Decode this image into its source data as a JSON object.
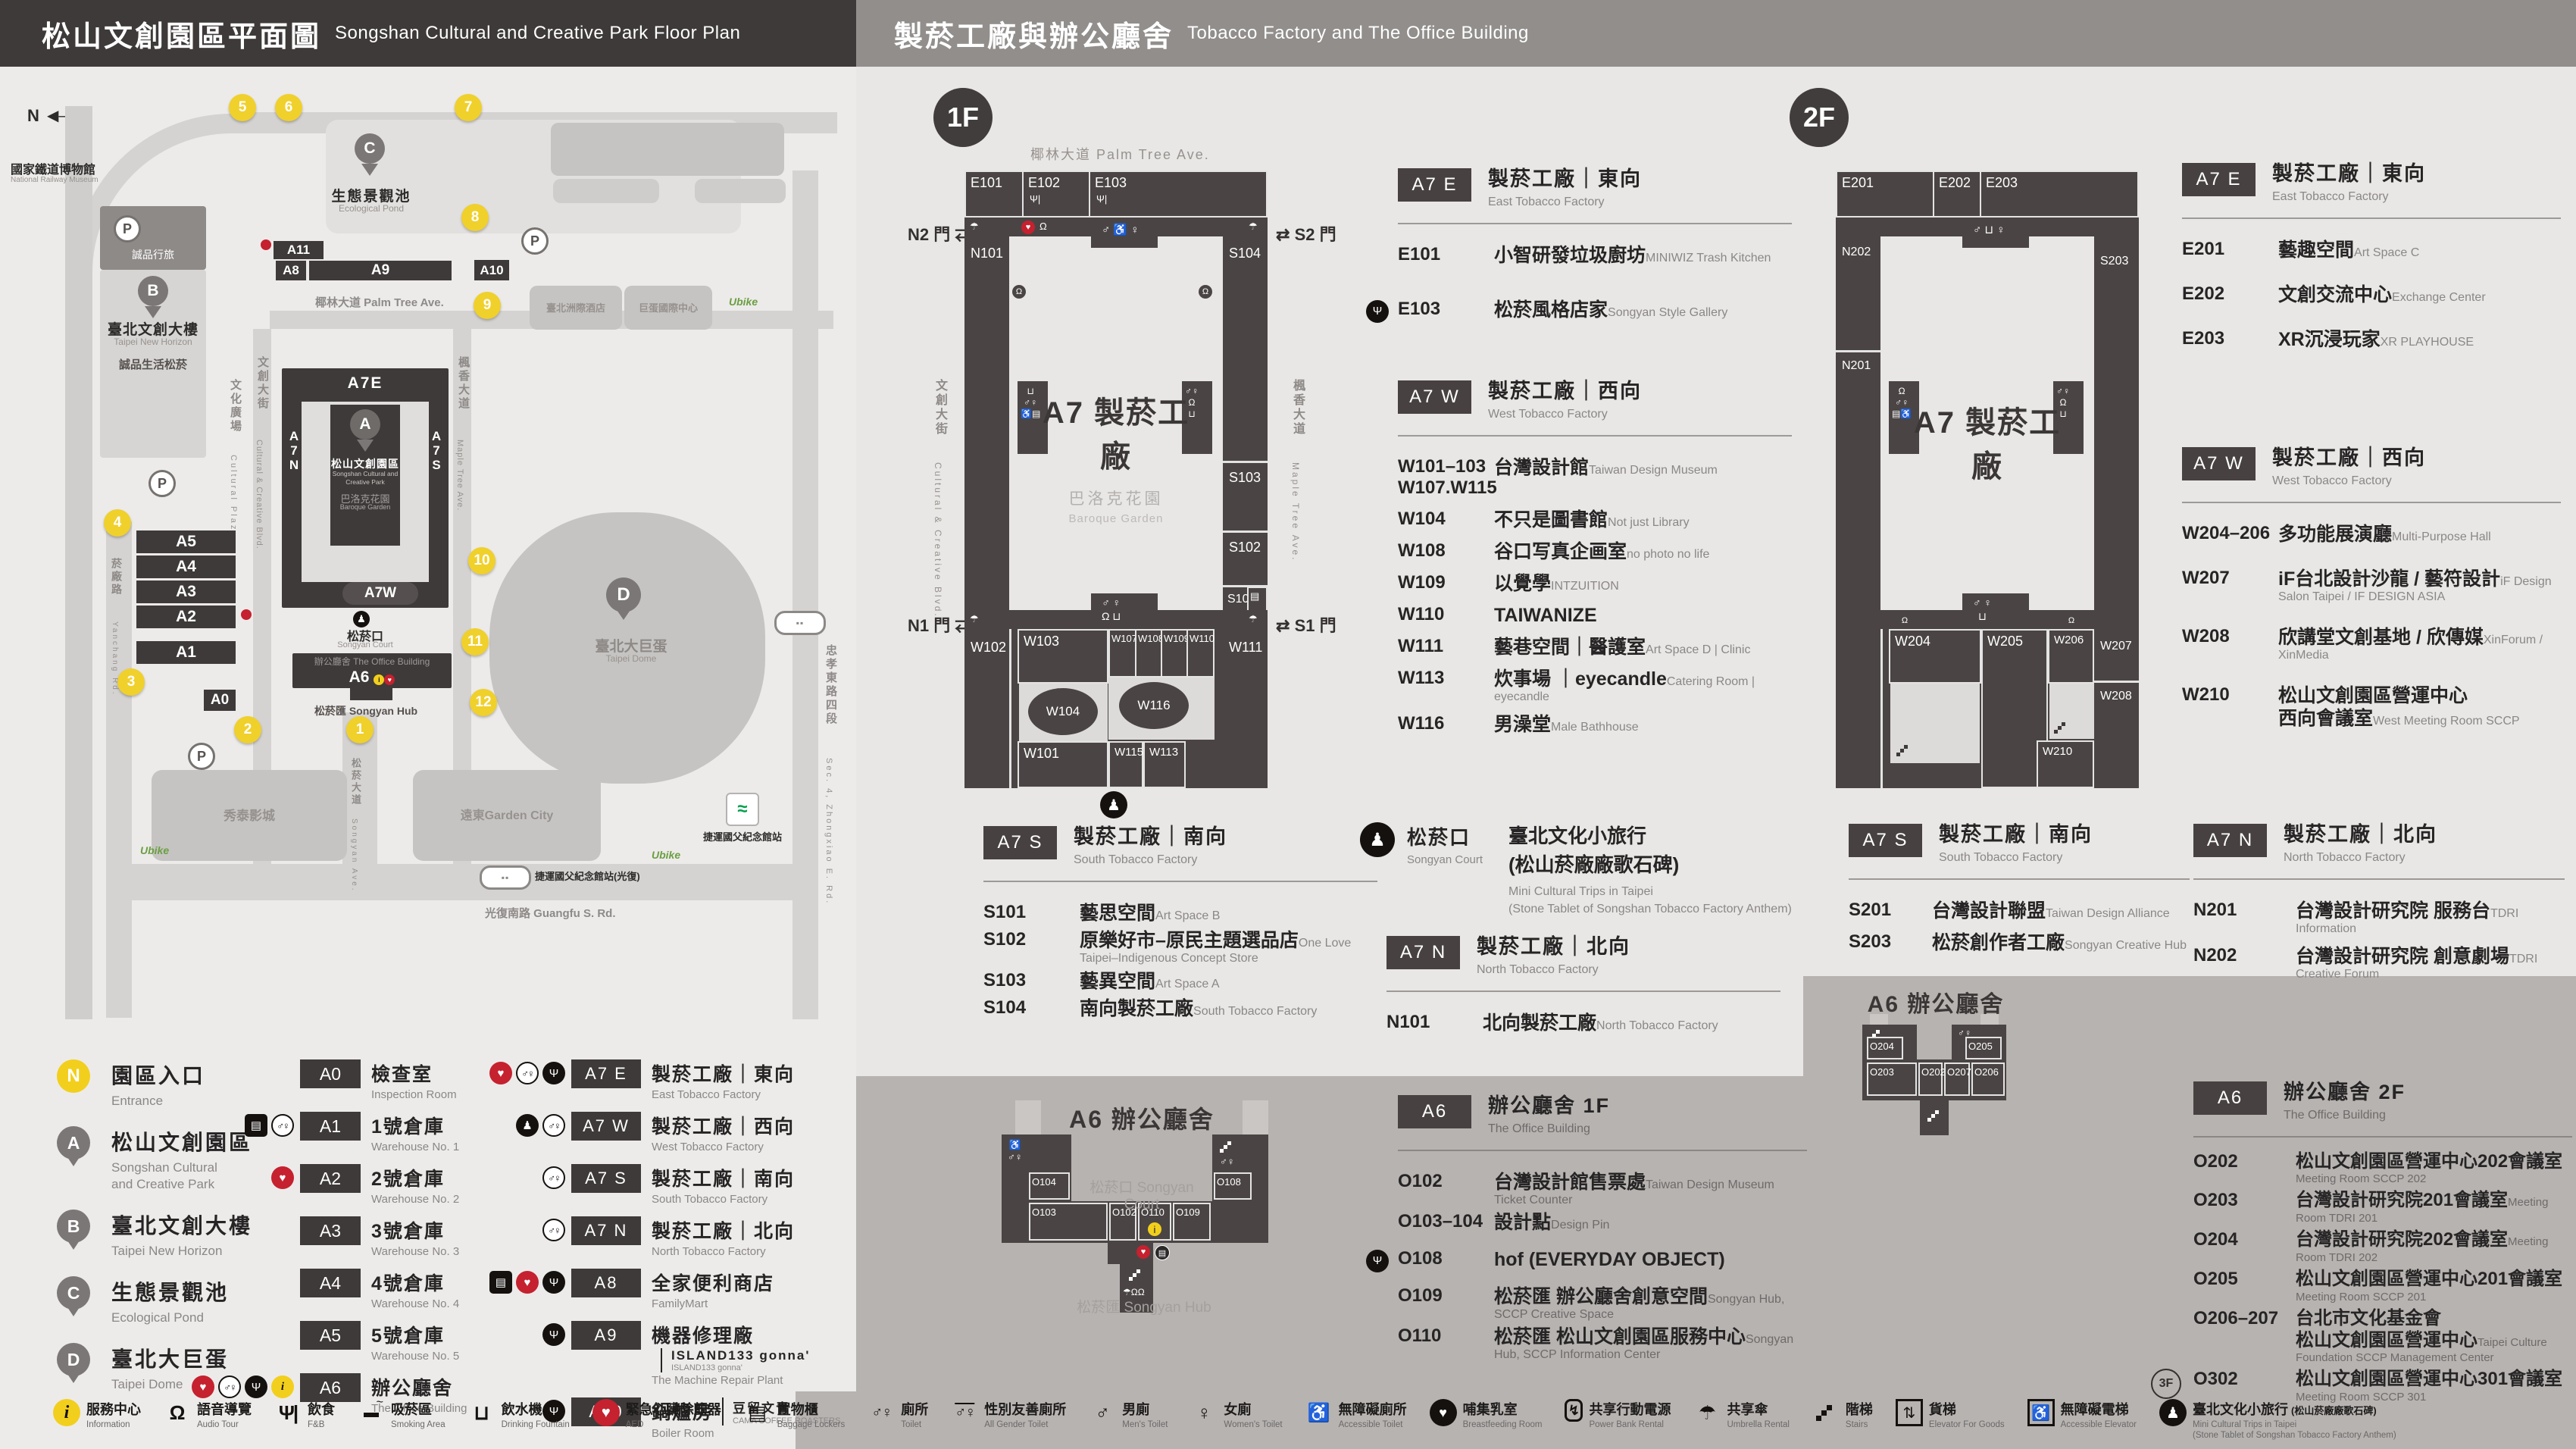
{
  "left": {
    "header": {
      "zh": "松山文創園區平面圖",
      "en": "Songshan Cultural and Creative Park Floor Plan"
    },
    "map": {
      "compass": "N",
      "gates": [
        "1",
        "2",
        "3",
        "4",
        "5",
        "6",
        "7",
        "8",
        "9",
        "10",
        "11",
        "12"
      ],
      "bars": {
        "a11": "A11",
        "a8": "A8",
        "a9": "A9",
        "a10": "A10",
        "a5": "A5",
        "a4": "A4",
        "a3": "A3",
        "a2": "A2",
        "a1": "A1",
        "a0": "A0"
      },
      "a7": {
        "e": "A7E",
        "w": "A7W",
        "n": "A7N",
        "s": "A7S",
        "pin": "A",
        "name_zh": "松山文創園區",
        "name_en1": "Songshan Cultural and",
        "name_en2": "Creative Park",
        "garden_zh": "巴洛克花園",
        "garden_en": "Baroque Garden"
      },
      "a6": {
        "tag": "A6",
        "zh": "辦公廳舍",
        "en": "The Office Building",
        "court_zh": "松菸口",
        "court_en": "Songyan Court",
        "hub": "松菸匯 Songyan Hub"
      },
      "streets": {
        "lane553": "忠孝東路四段553巷 La. 553, Sec. 4, Zhongxiao E. Rd.",
        "palm": "椰林大道 Palm Tree Ave.",
        "cultural_zh": "文創大街",
        "cultural_en": "Cultural & Creative Blvd.",
        "maple_zh": "楓香大道",
        "maple_en": "Maple Tree Ave.",
        "songyan_zh": "松菸大道",
        "songyan_en": "Songyan Ave.",
        "yanchang_zh": "菸廠路",
        "yanchang_en": "Yanchang Rd.",
        "plaza_zh": "文化廣場",
        "plaza_en": "Cultural Plaza",
        "guangfu": "光復南路 Guangfu S. Rd.",
        "zhongxiao_zh": "忠孝東路四段",
        "zhongxiao_en": "Sec. 4, Zhongxiao E. Rd."
      },
      "places": {
        "museum_zh": "國家鐵道博物館",
        "museum_en": "National Railway Museum",
        "pond_pin": "C",
        "pond_zh": "生態景觀池",
        "pond_en": "Ecological Pond",
        "hotel": "誠品行旅",
        "b_pin": "B",
        "b_zh": "臺北文創大樓",
        "b_en": "Taipei New Horizon",
        "eslite": "誠品生活松菸",
        "d_pin": "D",
        "d_zh": "臺北大巨蛋",
        "d_en": "Taipei Dome",
        "intercont": "臺北洲際酒店",
        "domeintl": "巨蛋國際中心",
        "cinema": "秀泰影城",
        "garden_city": "遠東Garden City",
        "mrt": "捷運國父紀念館站",
        "mrt_exit": "捷運國父紀念館站(光復)",
        "ubike": "Ubike",
        "parking": "P"
      }
    },
    "pins": [
      {
        "id": "N",
        "gold": true,
        "zh": "園區入口",
        "en": "Entrance"
      },
      {
        "id": "A",
        "pin": true,
        "zh": "松山文創園區",
        "en": "Songshan Cultural\nand Creative Park"
      },
      {
        "id": "B",
        "pin": true,
        "zh": "臺北文創大樓",
        "en": "Taipei New Horizon"
      },
      {
        "id": "C",
        "pin": true,
        "zh": "生態景觀池",
        "en": "Ecological Pond"
      },
      {
        "id": "D",
        "pin": true,
        "zh": "臺北大巨蛋",
        "en": "Taipei Dome"
      }
    ],
    "legend_a": [
      {
        "code": "A0",
        "zh": "檢查室",
        "en": "Inspection Room",
        "icons": []
      },
      {
        "code": "A1",
        "zh": "1號倉庫",
        "en": "Warehouse No. 1",
        "icons": [
          "locker",
          "toilet"
        ]
      },
      {
        "code": "A2",
        "zh": "2號倉庫",
        "en": "Warehouse No. 2",
        "icons": [
          "aed"
        ]
      },
      {
        "code": "A3",
        "zh": "3號倉庫",
        "en": "Warehouse No. 3",
        "icons": []
      },
      {
        "code": "A4",
        "zh": "4號倉庫",
        "en": "Warehouse No. 4",
        "icons": []
      },
      {
        "code": "A5",
        "zh": "5號倉庫",
        "en": "Warehouse No. 5",
        "icons": []
      },
      {
        "code": "A6",
        "zh": "辦公廳舍",
        "en": "The Office Building",
        "icons": [
          "aed",
          "toilet",
          "fnb",
          "info"
        ]
      }
    ],
    "legend_b": [
      {
        "code": "A7 E",
        "zh": "製菸工廠｜東向",
        "en": "East Tobacco Factory",
        "icons": [
          "aed",
          "toilet",
          "fnb"
        ]
      },
      {
        "code": "A7 W",
        "zh": "製菸工廠｜西向",
        "en": "West Tobacco Factory",
        "icons": [
          "statue",
          "toilet"
        ]
      },
      {
        "code": "A7 S",
        "zh": "製菸工廠｜南向",
        "en": "South Tobacco Factory",
        "icons": [
          "toilet"
        ]
      },
      {
        "code": "A7 N",
        "zh": "製菸工廠｜北向",
        "en": "North Tobacco Factory",
        "icons": [
          "toilet"
        ]
      },
      {
        "code": "A8",
        "zh": "全家便利商店",
        "en": "FamilyMart",
        "icons": [
          "locker",
          "aed",
          "fnb"
        ]
      },
      {
        "code": "A9",
        "zh": "機器修理廠",
        "side": "ISLAND133 gonna'",
        "side2": "ISLAND133 gonna'",
        "en": "The Machine Repair Plant",
        "icons": [
          "fnb"
        ]
      },
      {
        "code": "A10",
        "zh": "鍋爐房",
        "side": "豆留文青",
        "side2": "CAMA COFFEE ROASTERS",
        "en": "Boiler Room",
        "icons": [
          "fnb"
        ]
      },
      {
        "code": "A11",
        "zh": "育嬰室",
        "side": "光一 一個時間",
        "side2": "GUANG YI IN TIME",
        "en": "The Nursery Room",
        "icons": [
          "fnb"
        ]
      }
    ]
  },
  "right": {
    "header": {
      "zh": "製菸工廠與辦公廳舍",
      "en": "Tobacco Factory and The Office Building"
    },
    "f1": {
      "badge": "1F",
      "plan": {
        "street_top": "椰林大道 Palm Tree Ave.",
        "street_left_zh": "文創大街",
        "street_left_en": "Cultural & Creative Blvd.",
        "street_right_zh": "楓香大道",
        "street_right_en": "Maple Tree Ave.",
        "gate_n2": "N2 門",
        "gate_s2": "S2 門",
        "gate_n1": "N1 門",
        "gate_s1": "S1 門",
        "arrows": "⇄",
        "center": "A7 製菸工廠",
        "garden_zh": "巴洛克花園",
        "garden_en": "Baroque Garden",
        "rooms": {
          "e101": "E101",
          "e102": "E102",
          "e103": "E103",
          "n101": "N101",
          "s104": "S104",
          "s103": "S103",
          "s102": "S102",
          "s101": "S101",
          "w102": "W102",
          "w103": "W103",
          "w104": "W104",
          "w107": "W107",
          "w108": "W108",
          "w109": "W109",
          "w110": "W110",
          "w111": "W111",
          "w115": "W115",
          "w113": "W113",
          "w116": "W116",
          "w101": "W101"
        }
      },
      "a7e": {
        "badge": "A7 E",
        "zh": "製菸工廠｜東向",
        "en": "East Tobacco Factory",
        "items": [
          {
            "code": "E101",
            "zh": "小智研發垃圾廚坊",
            "en": "MINIWIZ Trash Kitchen"
          },
          {
            "code": "E103",
            "zh": "松菸風格店家",
            "en": "Songyan Style Gallery",
            "fnb": true
          }
        ]
      },
      "a7w": {
        "badge": "A7 W",
        "zh": "製菸工廠｜西向",
        "en": "West Tobacco Factory",
        "items": [
          {
            "code": "W101–103\nW107.W115",
            "zh": "台灣設計館",
            "en": "Taiwan Design Museum"
          },
          {
            "code": "W104",
            "zh": "不只是圖書館",
            "en": "Not just Library"
          },
          {
            "code": "W108",
            "zh": "谷口写真企画室",
            "en": "no photo no life"
          },
          {
            "code": "W109",
            "zh": "以覺學",
            "en": "INTZUITION"
          },
          {
            "code": "W110",
            "zh": "TAIWANIZE"
          },
          {
            "code": "W111",
            "zh": "藝巷空間｜醫護室",
            "en": "Art Space D | Clinic"
          },
          {
            "code": "W113",
            "zh": "炊事場 ｜eyecandle",
            "en": "Catering Room | eyecandle"
          },
          {
            "code": "W116",
            "zh": "男澡堂",
            "en": "Male Bathhouse"
          }
        ]
      },
      "a7s": {
        "badge": "A7 S",
        "zh": "製菸工廠｜南向",
        "en": "South Tobacco Factory",
        "items": [
          {
            "code": "S101",
            "zh": "藝思空間",
            "en": "Art Space B"
          },
          {
            "code": "S102",
            "zh": "原樂好市–原民主題選品店",
            "en": "One Love Taipei–Indigenous Concept Store"
          },
          {
            "code": "S103",
            "zh": "藝異空間",
            "en": "Art Space A"
          },
          {
            "code": "S104",
            "zh": "南向製菸工廠",
            "en": "South Tobacco Factory"
          }
        ]
      },
      "court": {
        "zh": "松菸口",
        "en": "Songyan Court",
        "t1": "臺北文化小旅行",
        "t2": "(松山菸廠廠歌石碑)",
        "e1": "Mini Cultural Trips in Taipei",
        "e2": "(Stone Tablet of Songshan Tobacco Factory Anthem)"
      },
      "a7n": {
        "badge": "A7 N",
        "zh": "製菸工廠｜北向",
        "en": "North Tobacco Factory",
        "items": [
          {
            "code": "N101",
            "zh": "北向製菸工廠",
            "en": "North Tobacco Factory"
          }
        ]
      },
      "a6": {
        "badge": "A6",
        "zh": "辦公廳舍 1F",
        "en": "The Office Building",
        "items": [
          {
            "code": "O102",
            "zh": "台灣設計館售票處",
            "en": "Taiwan Design Museum Ticket Counter"
          },
          {
            "code": "O103–104",
            "zh": "設計點",
            "en": "Design Pin"
          },
          {
            "code": "O108",
            "zh": "hof (EVERYDAY OBJECT)",
            "fnb": true
          },
          {
            "code": "O109",
            "zh": "松菸匯 辦公廳舍創意空間",
            "en": "Songyan Hub, SCCP Creative Space"
          },
          {
            "code": "O110",
            "zh": "松菸匯 松山文創園區服務中心",
            "en": "Songyan Hub, SCCP Information Center"
          }
        ],
        "plan": {
          "title": "A6 辦公廳舍",
          "court": "松菸口 Songyan Court",
          "hub": "松菸匯 Songyan Hub",
          "rooms": {
            "o104": "O104",
            "o103": "O103",
            "o102": "O102",
            "o110": "O110",
            "o109": "O109",
            "o108": "O108"
          }
        }
      }
    },
    "f2": {
      "badge": "2F",
      "plan": {
        "center": "A7 製菸工廠",
        "rooms": {
          "e201": "E201",
          "e202": "E202",
          "e203": "E203",
          "n202": "N202",
          "n201": "N201",
          "s203": "S203",
          "s201": "S201",
          "w204": "W204",
          "w205": "W205",
          "w206": "W206",
          "w207": "W207",
          "w208": "W208",
          "w210": "W210"
        }
      },
      "a7e": {
        "badge": "A7 E",
        "zh": "製菸工廠｜東向",
        "en": "East Tobacco Factory",
        "items": [
          {
            "code": "E201",
            "zh": "藝趣空間",
            "en": "Art Space C"
          },
          {
            "code": "E202",
            "zh": "文創交流中心",
            "en": "Exchange Center"
          },
          {
            "code": "E203",
            "zh": "XR沉浸玩家",
            "en": "XR PLAYHOUSE"
          }
        ]
      },
      "a7w": {
        "badge": "A7 W",
        "zh": "製菸工廠｜西向",
        "en": "West Tobacco Factory",
        "items": [
          {
            "code": "W204–206",
            "zh": "多功能展演廳",
            "en": "Multi-Purpose Hall"
          },
          {
            "code": "W207",
            "zh": "iF台北設計沙龍 / 藝符設計",
            "en": "iF Design Salon Taipei / IF DESIGN ASIA"
          },
          {
            "code": "W208",
            "zh": "欣講堂文創基地 / 欣傳媒",
            "en": "XinForum / XinMedia"
          },
          {
            "code": "W210",
            "zh": "松山文創園區營運中心\n西向會議室",
            "en": "West Meeting Room SCCP"
          }
        ]
      },
      "a7s": {
        "badge": "A7 S",
        "zh": "製菸工廠｜南向",
        "en": "South Tobacco Factory",
        "items": [
          {
            "code": "S201",
            "zh": "台灣設計聯盟",
            "en": "Taiwan Design Alliance"
          },
          {
            "code": "S203",
            "zh": "松菸創作者工廠",
            "en": "Songyan Creative Hub"
          }
        ]
      },
      "a7n": {
        "badge": "A7 N",
        "zh": "製菸工廠｜北向",
        "en": "North Tobacco Factory",
        "items": [
          {
            "code": "N201",
            "zh": "台灣設計研究院 服務台",
            "en": "TDRI Information"
          },
          {
            "code": "N202",
            "zh": "台灣設計研究院 創意劇場",
            "en": "TDRI Creative Forum"
          }
        ]
      },
      "a6": {
        "badge": "A6",
        "zh": "辦公廳舍 2F",
        "en": "The Office Building",
        "items": [
          {
            "code": "O202",
            "zh": "松山文創園區營運中心202會議室",
            "en": "Meeting Room SCCP 202"
          },
          {
            "code": "O203",
            "zh": "台灣設計研究院201會議室",
            "en": "Meeting Room TDRI 201"
          },
          {
            "code": "O204",
            "zh": "台灣設計研究院202會議室",
            "en": "Meeting Room TDRI 202"
          },
          {
            "code": "O205",
            "zh": "松山文創園區營運中心201會議室",
            "en": "Meeting Room SCCP 201"
          },
          {
            "code": "O206–207",
            "zh": "台北市文化基金會\n松山文創園區營運中心",
            "en": "Taipei Culture Foundation SCCP Management Center"
          },
          {
            "code": "O302",
            "zh": "松山文創園區營運中心301會議室",
            "en": "Meeting Room SCCP 301",
            "tag": "3F"
          }
        ],
        "plan": {
          "title": "A6 辦公廳舍",
          "rooms": {
            "o204": "O204",
            "o203": "O203",
            "o202": "O202",
            "o207": "O207",
            "o206": "O206",
            "o205": "O205"
          }
        }
      }
    }
  },
  "strip": [
    {
      "icon": "info",
      "zh": "服務中心",
      "en": "Information"
    },
    {
      "icon": "audio",
      "zh": "語音導覽",
      "en": "Audio Tour"
    },
    {
      "icon": "fnb",
      "zh": "飲食",
      "en": "F&B"
    },
    {
      "icon": "smoking",
      "zh": "吸菸區",
      "en": "Smoking Area"
    },
    {
      "icon": "water",
      "zh": "飲水機",
      "en": "Drinking Fountain"
    },
    {
      "icon": "aed",
      "zh": "緊急心臟除顫器",
      "en": "AED"
    },
    {
      "icon": "locker",
      "zh": "置物櫃",
      "en": "Baggage Lockers"
    },
    {
      "icon": "toilet",
      "zh": "廁所",
      "en": "Toilet"
    },
    {
      "icon": "allgender",
      "zh": "性別友善廁所",
      "en": "All Gender Toilet"
    },
    {
      "icon": "men",
      "zh": "男廁",
      "en": "Men's Toilet"
    },
    {
      "icon": "women",
      "zh": "女廁",
      "en": "Women's Toilet"
    },
    {
      "icon": "accessible",
      "zh": "無障礙廁所",
      "en": "Accessible Toilet"
    },
    {
      "icon": "nursing",
      "zh": "哺集乳室",
      "en": "Breastfeeding Room"
    },
    {
      "icon": "powerbank",
      "zh": "共享行動電源",
      "en": "Power Bank Rental"
    },
    {
      "icon": "umbrella",
      "zh": "共享傘",
      "en": "Umbrella Rental"
    },
    {
      "icon": "stairs",
      "zh": "階梯",
      "en": "Stairs"
    },
    {
      "icon": "goodslift",
      "zh": "貨梯",
      "en": "Elevator For Goods"
    },
    {
      "icon": "acclift",
      "zh": "無障礙電梯",
      "en": "Accessible Elevator"
    },
    {
      "icon": "statue",
      "zh": "臺北文化小旅行",
      "zh2": "(松山菸廠廠歌石碑)",
      "en": "Mini Cultural Trips in Taipei",
      "en2": "(Stone Tablet of Songshan Tobacco Factory Anthem)"
    }
  ]
}
